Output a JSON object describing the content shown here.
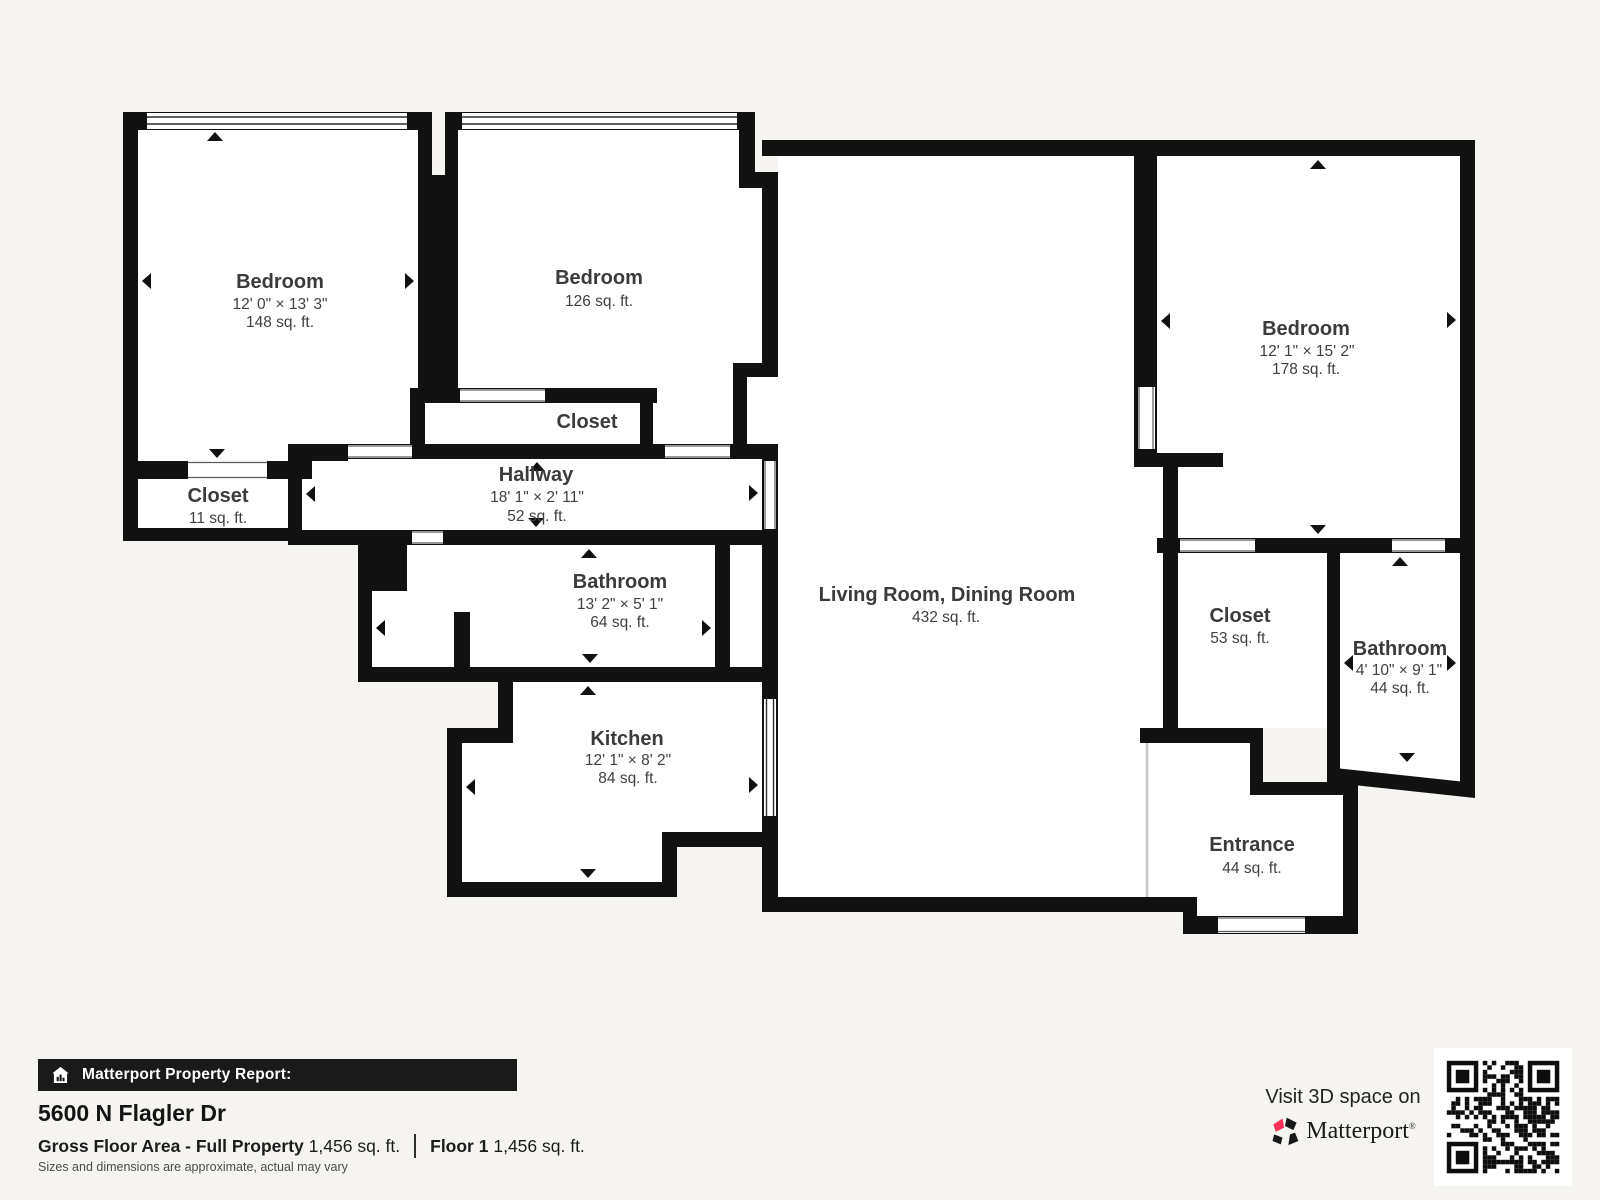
{
  "rooms": [
    {
      "name": "Bedroom",
      "dims": "12' 0\" × 13' 3\"",
      "area": "148 sq. ft."
    },
    {
      "name": "Bedroom",
      "area": "126 sq. ft."
    },
    {
      "name": "Closet",
      "area": "11 sq. ft."
    },
    {
      "name": "Closet"
    },
    {
      "name": "Hallway",
      "dims": "18' 1\" × 2' 11\"",
      "area": "52 sq. ft."
    },
    {
      "name": "Bathroom",
      "dims": "13' 2\" × 5' 1\"",
      "area": "64 sq. ft."
    },
    {
      "name": "Kitchen",
      "dims": "12' 1\" × 8' 2\"",
      "area": "84 sq. ft."
    },
    {
      "name": "Living Room, Dining Room",
      "area": "432 sq. ft."
    },
    {
      "name": "Bedroom",
      "dims": "12' 1\" × 15' 2\"",
      "area": "178 sq. ft."
    },
    {
      "name": "Closet",
      "area": "53 sq. ft."
    },
    {
      "name": "Bathroom",
      "dims": "4' 10\" × 9' 1\"",
      "area": "44 sq. ft."
    },
    {
      "name": "Entrance",
      "area": "44 sq. ft."
    }
  ],
  "report": {
    "bar_label": "Matterport Property Report:",
    "address": "5600 N Flagler Dr",
    "gross_label": "Gross Floor Area - Full Property",
    "gross_value": "1,456 sq. ft.",
    "floor_label": "Floor 1",
    "floor_value": "1,456 sq. ft.",
    "disclaimer": "Sizes and dimensions are approximate, actual may vary"
  },
  "promo": {
    "visit_text": "Visit 3D space on",
    "brand": "Matterport",
    "registered": "®"
  },
  "icons": {
    "bar_icon": "house-report-icon",
    "brand_icon": "matterport-pinwheel-icon",
    "qr": "qr-code"
  },
  "colors": {
    "wall": "#111111",
    "background": "#f5f4f1",
    "room_fill": "#ffffff",
    "label": "#3b3b3b",
    "brand_red": "#ff3158"
  }
}
